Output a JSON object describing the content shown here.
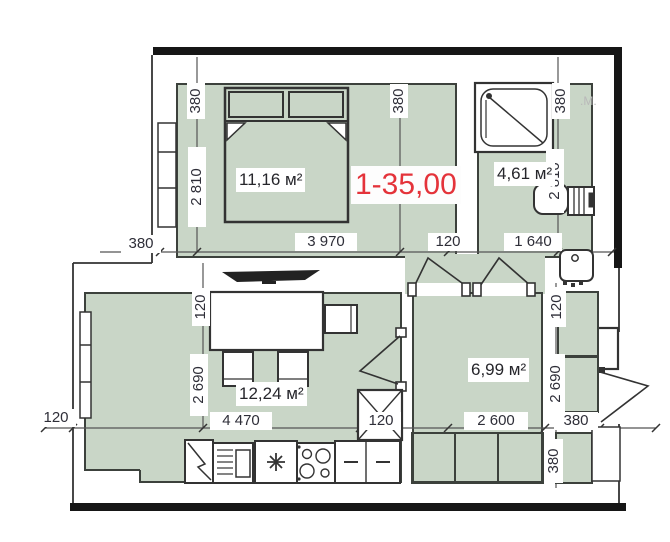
{
  "plan": {
    "unit_label": "1-35,00",
    "watermark": ".М.",
    "rooms": [
      {
        "name": "bedroom",
        "area": "11,16 м²"
      },
      {
        "name": "bathroom",
        "area": "4,61 м²"
      },
      {
        "name": "living-kitchen",
        "area": "12,24 м²"
      },
      {
        "name": "hallway",
        "area": "6,99 м²"
      }
    ],
    "dims_h": [
      "380",
      "3 970",
      "120",
      "1 640",
      "120",
      "4 470",
      "120",
      "2 600",
      "380"
    ],
    "dims_v": [
      "380",
      "2 810",
      "380",
      "380",
      "2 810",
      "120",
      "2 690",
      "120",
      "2 690",
      "380"
    ],
    "colors": {
      "room_fill": "#c9d6c7",
      "wall": "#161616",
      "dim_text": "#2e2e38",
      "unit_label_color": "#e4333a"
    }
  }
}
